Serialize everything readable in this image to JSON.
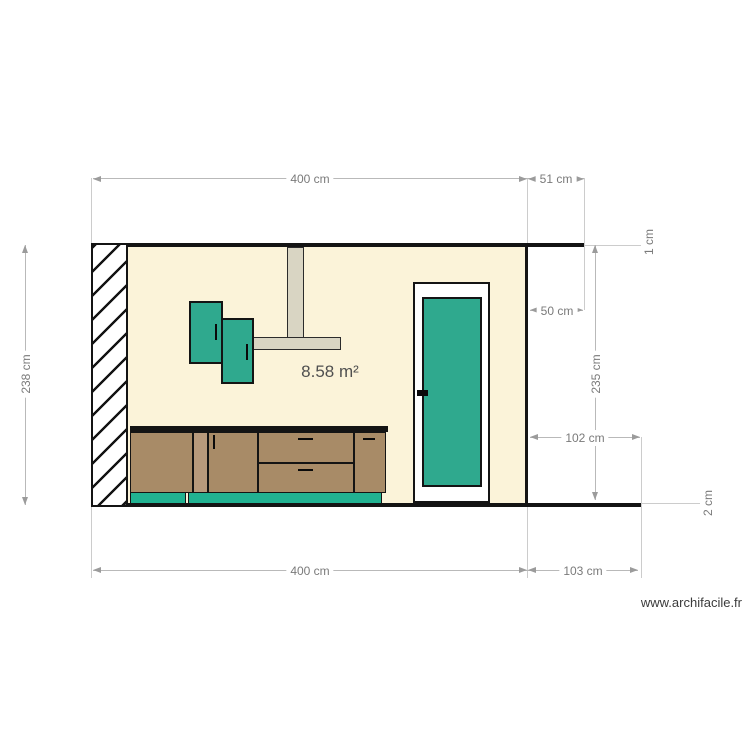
{
  "watermark": "www.archifacile.fr",
  "plan": {
    "area": "8.58 m²",
    "dims": {
      "top_width": "400 cm",
      "top_right": "51 cm",
      "ceiling": "1 cm",
      "left_height": "238 cm",
      "upper_right": "50 cm",
      "inner_height": "235 cm",
      "lower_right": "102 cm",
      "floor": "2 cm",
      "bottom_width": "400 cm",
      "bottom_right": "103 cm"
    },
    "colors": {
      "wall_fill": "#fbf3d9",
      "structure_black": "#141414",
      "cabinet_teal": "#2fa98e",
      "kickboard_teal": "#21b291",
      "cabinet_brown": "#a88b67",
      "cabinet_brown_light": "#b79a7c",
      "hood_fill": "#d9d5c3",
      "dim_line": "#b9b9b9",
      "dim_text": "#7a7a7a"
    }
  }
}
